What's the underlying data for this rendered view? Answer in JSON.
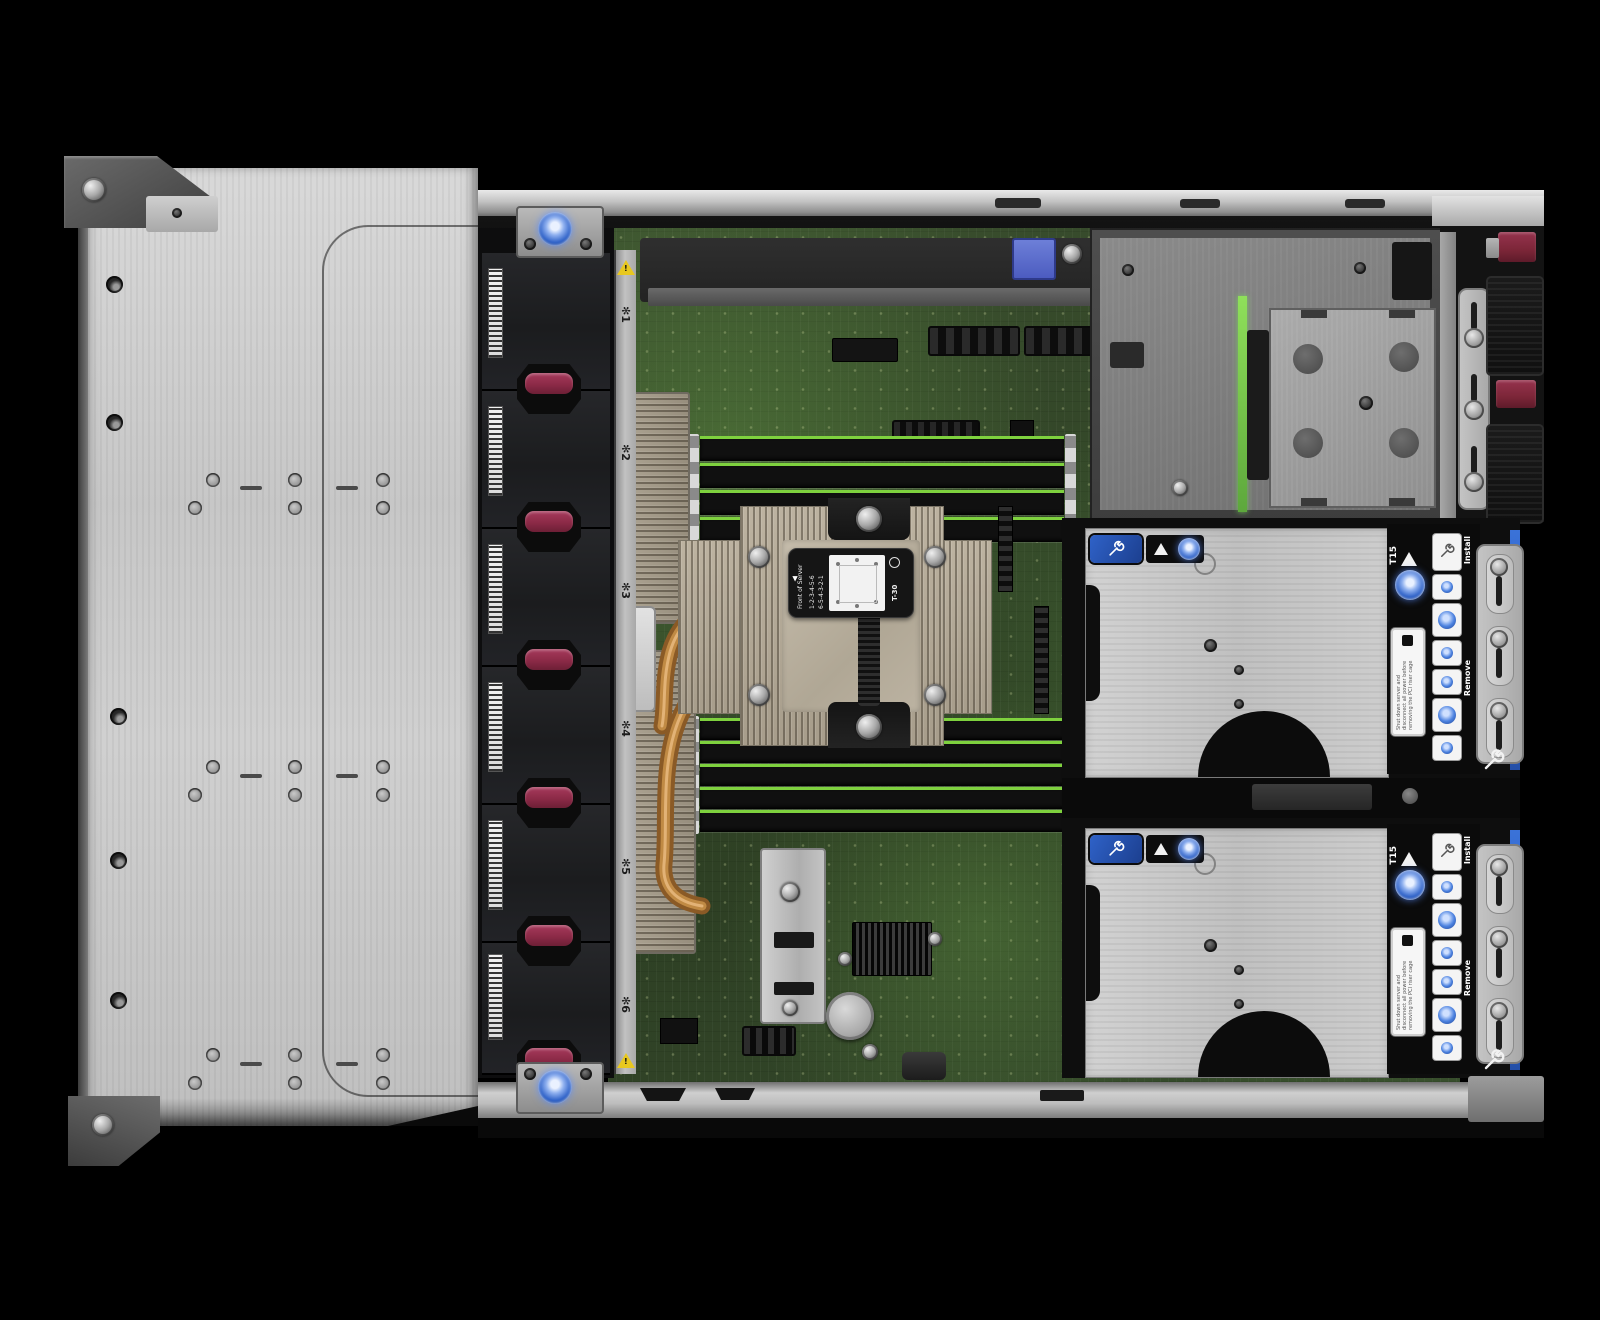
{
  "scene_labels": {
    "fan_icon": "✻",
    "fan_numbers": [
      "1",
      "2",
      "3",
      "4",
      "5",
      "6"
    ],
    "warning_mark": "!",
    "heatsink_label": {
      "front_arrow": "▲",
      "front_text": "Front of Server",
      "install": "Install",
      "install_seq": "1-2-3-4-5-6",
      "remove": "Remove",
      "remove_seq": "6-5-4-3-2-1",
      "torx": "T-30"
    },
    "riser_sticker": {
      "torx": "T15",
      "triangle": "▲",
      "install": "Install",
      "remove": "Remove",
      "warning": "Shut down server and disconnect all power before removing the PCI riser cage"
    }
  },
  "colors": {
    "background": "#000000",
    "chassis_metal": "#c9c9c9",
    "fan_body": "#1d1e20",
    "fan_latch_maroon": "#8c2a47",
    "pcb_green": "#33472a",
    "dimm_edge_green": "#7ed13e",
    "heatsink_beige": "#b3a996",
    "copper_pipe": "#b07a36",
    "hpe_blue": "#2f62c8",
    "bracket_green": "#6cc04a",
    "psu_tab_maroon": "#7c2638",
    "warning_yellow": "#e8c820"
  }
}
